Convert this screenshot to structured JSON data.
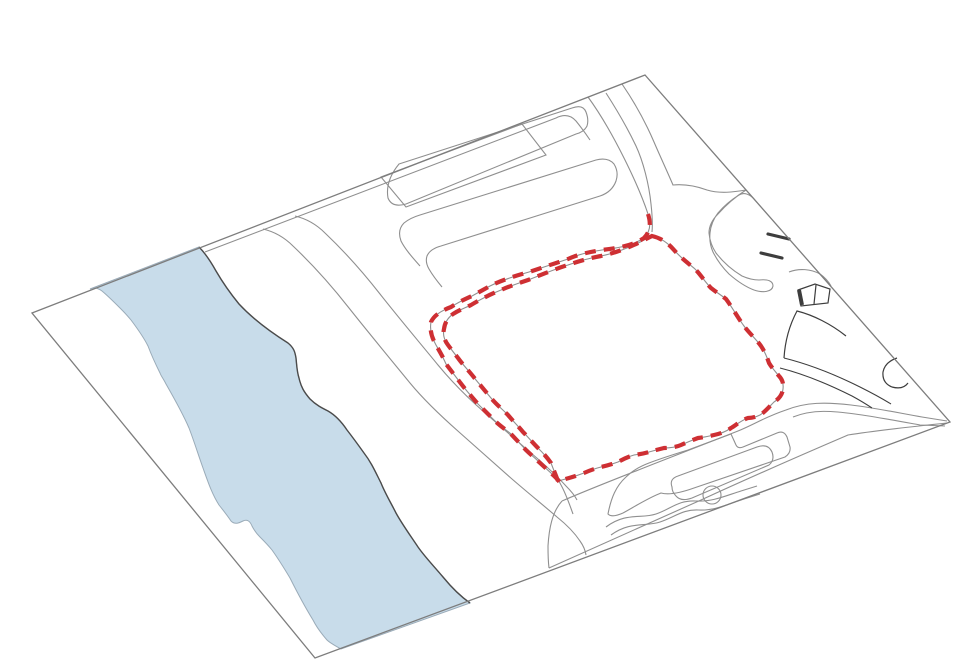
{
  "canvas": {
    "width": 961,
    "height": 669,
    "background": "#ffffff"
  },
  "colors": {
    "background": "#ffffff",
    "plane_fill": "#ffffff",
    "plane_outline": "#7d7d7d",
    "road_line": "#8f8f8f",
    "road_line_dark": "#3d3d3d",
    "river_fill": "#c8dcea",
    "river_edge": "#9aabb8",
    "river_bank_dark": "#4b4b4b",
    "site_boundary": "#ce2f33"
  },
  "site_boundary": {
    "stroke_width": 4.2,
    "dash_pattern": "11 8"
  },
  "elements": {
    "ground_plane": "ground-plane",
    "river": "river",
    "streets": "street-network",
    "city_blocks": "city-blocks",
    "site_boundary_inner": "site-boundary-inner-loop",
    "site_boundary_outer": "site-boundary-outer-offset",
    "loop_road": "loop-road",
    "parking_ticks": "parking-ticks",
    "small_building": "small-building",
    "roundabout_circle": "small-circle",
    "bottom_road": "bottom-road-band",
    "median_island": "median-island",
    "footpath": "winding-footpath"
  }
}
